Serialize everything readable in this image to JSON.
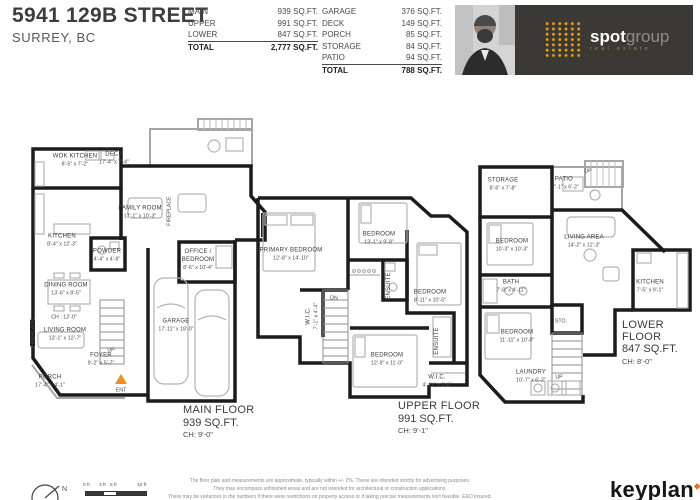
{
  "address": {
    "line1": "5941 129B STREET",
    "line2": "SURREY, BC"
  },
  "interior_table": {
    "rows": [
      {
        "label": "MAIN",
        "value": "939 SQ.FT."
      },
      {
        "label": "UPPER",
        "value": "991 SQ.FT."
      },
      {
        "label": "LOWER",
        "value": "847 SQ.FT."
      }
    ],
    "total_label": "TOTAL",
    "total_value": "2,777 SQ.FT."
  },
  "exterior_table": {
    "rows": [
      {
        "label": "GARAGE",
        "value": "376 SQ.FT."
      },
      {
        "label": "DECK",
        "value": "149 SQ.FT."
      },
      {
        "label": "PORCH",
        "value": "85 SQ.FT."
      },
      {
        "label": "STORAGE",
        "value": "84 SQ.FT."
      },
      {
        "label": "PATIO",
        "value": "94 SQ.FT."
      }
    ],
    "total_label": "TOTAL",
    "total_value": "788 SQ.FT."
  },
  "branding": {
    "bold": "spot",
    "light": "group",
    "tagline": "real estate",
    "accent_color": "#F0A20A",
    "banner_bg": "#3B3936"
  },
  "floors": [
    {
      "title": "MAIN FLOOR",
      "area": "939 SQ.FT.",
      "ceiling": "CH: 9'-0\"",
      "rooms": [
        {
          "name": "WOK KITCHEN",
          "dims": "8'-5\" x 7'-2\""
        },
        {
          "name": "DECK",
          "dims": "17'-4\" x 7'-4\""
        },
        {
          "name": "FAMILY ROOM",
          "dims": "17'-1\" x 10'-3\""
        },
        {
          "name": "KITCHEN",
          "dims": "8'-4\" x 12'-3\""
        },
        {
          "name": "POWDER",
          "dims": "4'-4\" x 4'-8\""
        },
        {
          "name": "OFFICE / BEDROOM",
          "dims": "8'-6\" x 10'-4\""
        },
        {
          "name": "DINING ROOM",
          "dims": "13'-6\" x 8'-5\""
        },
        {
          "name": "LIVING ROOM",
          "dims": "13'-1\" x 12'-7\""
        },
        {
          "name": "FOYER",
          "dims": "9'-2\" x 5'-7\""
        },
        {
          "name": "PORCH",
          "dims": "17'-4\" x 4'-1\""
        },
        {
          "name": "GARAGE",
          "dims": "17'-11\" x 18'-0\""
        }
      ],
      "notes": {
        "ch_note": "CH : 12'-0\"",
        "up": "UP",
        "ent": "ENT",
        "fireplace": "FIREPLACE"
      }
    },
    {
      "title": "UPPER FLOOR",
      "area": "991 SQ.FT.",
      "ceiling": "CH: 9'-1\"",
      "rooms": [
        {
          "name": "PRIMARY BEDROOM",
          "dims": "12'-8\" x 14'-10\""
        },
        {
          "name": "BEDROOM",
          "dims": "13'-1\" x 9'-8\""
        },
        {
          "name": "ENSUITE",
          "dims": ""
        },
        {
          "name": "W.I.C.",
          "dims": "7'-1\" x 4'-4\""
        },
        {
          "name": "BEDROOM",
          "dims": "8'-11\" x 10'-5\""
        },
        {
          "name": "BEDROOM",
          "dims": "12'-9\" x 11'-0\""
        },
        {
          "name": "ENSUITE",
          "dims": ""
        },
        {
          "name": "W.I.C.",
          "dims": "4'-11\" x 2'-6\""
        }
      ],
      "notes": {
        "dn": "DN"
      }
    },
    {
      "title": "LOWER FLOOR",
      "area": "847 SQ.FT.",
      "ceiling": "CH: 8'-0\"",
      "rooms": [
        {
          "name": "STORAGE",
          "dims": "8'-6\" x 7'-8\""
        },
        {
          "name": "PATIO",
          "dims": "17'-1\" x 6'-2\""
        },
        {
          "name": "BEDROOM",
          "dims": "10'-3\" x 10'-3\""
        },
        {
          "name": "LIVING AREA",
          "dims": "14'-2\" x 12'-3\""
        },
        {
          "name": "BATH",
          "dims": "7'-8\" x 4'-11\""
        },
        {
          "name": "KITCHEN",
          "dims": "7'-5\" x 9'-1\""
        },
        {
          "name": "BEDROOM",
          "dims": "11'-11\" x 10'-0\""
        },
        {
          "name": "STO.",
          "dims": ""
        },
        {
          "name": "LAUNDRY",
          "dims": "10'-7\" x 6'-2\""
        }
      ],
      "notes": {
        "up_top": "UP",
        "up_bottom": "UP"
      }
    }
  ],
  "footer": {
    "north": "N",
    "scale_ticks": [
      "0 ft",
      "3 ft",
      "5 ft",
      "10 ft"
    ],
    "disclaimer": [
      "The floor plan and measurements are approximate, typically within +/- 2%. These are intended strictly for advertising purposes.",
      "They may encompass unfinished areas and are not intended for architectural or construction applications.",
      "There may be variances in the numbers if there were restrictions on property access or if taking precise measurements isn't feasible. E&O insured."
    ],
    "brand": "keyplan"
  }
}
